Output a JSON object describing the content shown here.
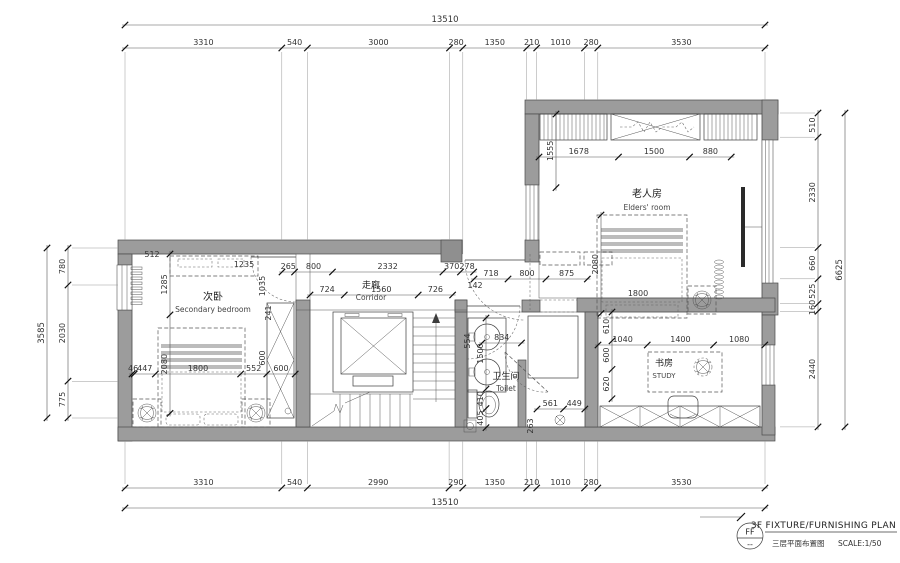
{
  "plan": {
    "rooms": {
      "elders": {
        "zh": "老人房",
        "en": "Elders' room"
      },
      "secondary": {
        "zh": "次卧",
        "en": "Secondary bedroom"
      },
      "corridor": {
        "zh": "走廊",
        "en": "Corridor"
      },
      "toilet": {
        "zh": "卫生间",
        "en": "Toilet"
      },
      "study": {
        "zh": "书房",
        "en": "STUDY"
      }
    }
  },
  "dimensions": {
    "top": {
      "total": [
        "13510"
      ],
      "segments": [
        "3310",
        "540",
        "3000",
        "280",
        "1350",
        "210",
        "1010",
        "280",
        "3530"
      ]
    },
    "bottom": {
      "total": [
        "13510"
      ],
      "segments": [
        "3310",
        "540",
        "2990",
        "290",
        "1350",
        "210",
        "1010",
        "280",
        "3530"
      ]
    },
    "left": {
      "total": [
        "3585"
      ],
      "segments": [
        "780",
        "2030",
        "775"
      ]
    },
    "right": {
      "total": [
        "6625"
      ],
      "segments": [
        "510",
        "2330",
        "660",
        "525",
        "160",
        "2440"
      ]
    },
    "interior": {
      "elders_top": [
        "1678",
        "1500",
        "880"
      ],
      "corridor_top_a": [
        "265",
        "800",
        "2332",
        "370",
        "278"
      ],
      "corridor_top_b": [
        "718",
        "800",
        "875"
      ],
      "corridor_bottom": [
        "724",
        "1560",
        "726"
      ],
      "bedroom_bottom": [
        "46",
        "447",
        "1800",
        "552",
        "600"
      ],
      "study_top": [
        "1040",
        "1400",
        "1080"
      ],
      "toilet_counter": [
        "834"
      ],
      "toilet_bottom": [
        "561",
        "449"
      ],
      "bedroom_v": [
        "1285",
        "2080"
      ],
      "elders_bed_v": [
        "2080"
      ],
      "elders_left_v": [
        "1555"
      ],
      "toilet_v": [
        "1500",
        "410",
        "405"
      ],
      "study_v": [
        "610",
        "600",
        "620"
      ]
    }
  },
  "dim_rows": [
    {
      "x": 125,
      "y": 25,
      "dir": "h",
      "path": "dimensions.top.total",
      "big": true
    },
    {
      "x": 125,
      "y": 48,
      "dir": "h",
      "path": "dimensions.top.segments"
    },
    {
      "x": 125,
      "y": 488,
      "dir": "h",
      "path": "dimensions.bottom.segments"
    },
    {
      "x": 125,
      "y": 508,
      "dir": "h",
      "path": "dimensions.bottom.total",
      "big": true
    },
    {
      "x": 47,
      "y": 248,
      "dir": "v",
      "path": "dimensions.left.total",
      "big": true
    },
    {
      "x": 68,
      "y": 248,
      "dir": "v",
      "path": "dimensions.left.segments"
    },
    {
      "x": 818,
      "y": 113,
      "dir": "v",
      "path": "dimensions.right.segments"
    },
    {
      "x": 845,
      "y": 113,
      "dir": "v",
      "path": "dimensions.right.total",
      "big": true
    },
    {
      "x": 539,
      "y": 157,
      "dir": "h",
      "path": "dimensions.interior.elders_top"
    },
    {
      "x": 282,
      "y": 272,
      "dir": "h",
      "path": "dimensions.interior.corridor_top_a"
    },
    {
      "x": 474,
      "y": 279,
      "dir": "h",
      "path": "dimensions.interior.corridor_top_b"
    },
    {
      "x": 310,
      "y": 295,
      "dir": "h",
      "path": "dimensions.interior.corridor_bottom"
    },
    {
      "x": 132,
      "y": 374,
      "dir": "h",
      "path": "dimensions.interior.bedroom_bottom"
    },
    {
      "x": 598,
      "y": 345,
      "dir": "h",
      "path": "dimensions.interior.study_top"
    },
    {
      "x": 482,
      "y": 343,
      "dir": "h",
      "path": "dimensions.interior.toilet_counter"
    },
    {
      "x": 537,
      "y": 409,
      "dir": "h",
      "path": "dimensions.interior.toilet_bottom"
    },
    {
      "x": 170,
      "y": 254,
      "dir": "v",
      "path": "dimensions.interior.bedroom_v"
    },
    {
      "x": 601,
      "y": 215,
      "dir": "v",
      "path": "dimensions.interior.elders_bed_v"
    },
    {
      "x": 556,
      "y": 114,
      "dir": "v",
      "path": "dimensions.interior.elders_left_v"
    },
    {
      "x": 486,
      "y": 318,
      "dir": "v",
      "path": "dimensions.interior.toilet_v"
    },
    {
      "x": 612,
      "y": 312,
      "dir": "v",
      "path": "dimensions.interior.study_v"
    }
  ],
  "annotations": [
    {
      "x": 152,
      "y": 257,
      "t": "512"
    },
    {
      "x": 244,
      "y": 267,
      "t": "1235"
    },
    {
      "x": 265,
      "y": 286,
      "t": "1035",
      "r": -90
    },
    {
      "x": 271,
      "y": 313,
      "t": "241",
      "r": -90
    },
    {
      "x": 265,
      "y": 358,
      "t": "600",
      "r": -90
    },
    {
      "x": 475,
      "y": 288,
      "t": "142"
    },
    {
      "x": 470,
      "y": 341,
      "t": "554",
      "r": -90
    },
    {
      "x": 533,
      "y": 426,
      "t": "263",
      "r": -90
    },
    {
      "x": 638,
      "y": 296,
      "t": "1800"
    }
  ],
  "titleblock": {
    "code": "FF",
    "dash": "--",
    "title_en": "3F FIXTURE/FURNISHING PLAN",
    "title_zh": "三层平面布置图",
    "scale": "SCALE:1/50"
  },
  "colors": {
    "wall_fill": "#9c9c9c",
    "line": "#3c3c3c",
    "dim_text": "#333333"
  }
}
